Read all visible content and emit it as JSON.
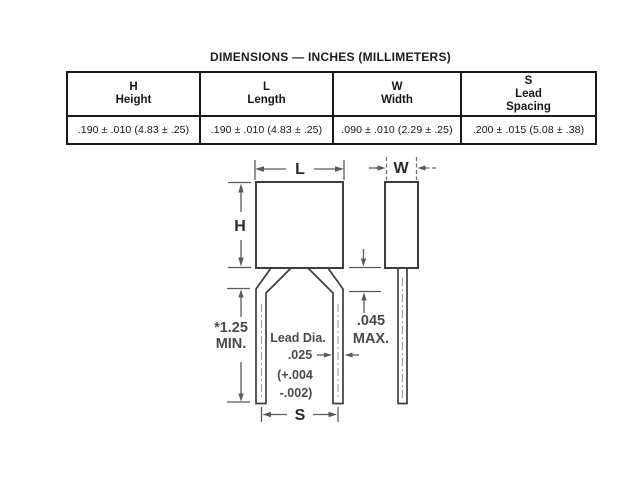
{
  "title": "DIMENSIONS — INCHES (MILLIMETERS)",
  "table": {
    "columns": [
      {
        "symbol": "H",
        "name": "Height",
        "value": ".190 ± .010 (4.83 ± .25)"
      },
      {
        "symbol": "L",
        "name": "Length",
        "value": ".190 ± .010 (4.83 ± .25)"
      },
      {
        "symbol": "W",
        "name": "Width",
        "value": ".090 ± .010 (2.29 ± .25)"
      },
      {
        "symbol": "S",
        "name": "Lead\nSpacing",
        "value": ".200 ± .015 (5.08 ± .38)"
      }
    ]
  },
  "diagram": {
    "length_label": "L",
    "width_label": "W",
    "height_label": "H",
    "spacing_label": "S",
    "standoff": {
      "line1": ".045",
      "line2": "MAX."
    },
    "lead_length": {
      "line1": "*1.25",
      "line2": "MIN."
    },
    "lead_diameter": {
      "line1": "Lead Dia.",
      "line2": ".025",
      "line3": "(+.004",
      "line4": "-.002)"
    }
  },
  "colors": {
    "background": "#ffffff",
    "table_border": "#1a1a1a",
    "object_line": "#3d3d3d",
    "dimension_line": "#5a5a5a",
    "annotation_text": "#4a4a4a",
    "centerline": "#9c9c9c"
  }
}
